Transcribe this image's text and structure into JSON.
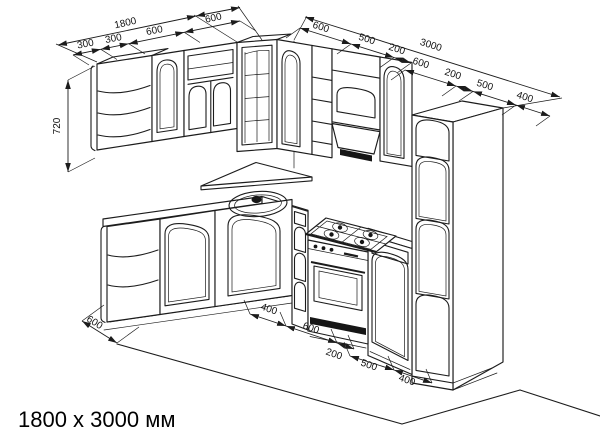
{
  "title": "1800 x 3000 мм",
  "dimensions": {
    "left_total": "1800",
    "left_end_segment": "600",
    "left_segments": [
      "300",
      "300",
      "600"
    ],
    "cabinet_height": "720",
    "right_total": "3000",
    "right_upper_segments": [
      "600",
      "500",
      "200"
    ],
    "right_lower_segments": [
      "600",
      "200",
      "500",
      "400"
    ],
    "bottom_left_depth": "600",
    "bottom_segments": [
      "400",
      "600",
      "200",
      "500",
      "400"
    ]
  },
  "colors": {
    "line": "#1c1c1c",
    "background": "#ffffff"
  }
}
